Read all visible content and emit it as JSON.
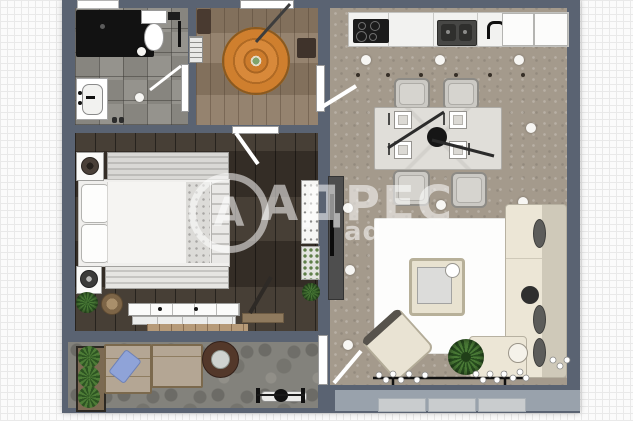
{
  "document": {
    "type": "apartment floor plan (top-down render) on graph paper with real-estate watermark",
    "background": "white graph paper grid"
  },
  "watermark": {
    "logo_letter": "А",
    "brand": "АДРЕС",
    "subtext_partial": "ad",
    "color": "rgba(255,255,255,0.55)"
  },
  "palette": {
    "paper": "#fbfbfb",
    "grid": "#e9e9e9",
    "wall": "#5a6372",
    "tile": "#8f8d87",
    "hallwood": "#8d7a64",
    "bedwood": "#40372e",
    "livfloor": "#a49a8c",
    "stone": "#83827c",
    "ledge": "#99a2ac",
    "bed": "#f0efed",
    "sofa": "#ece6d6",
    "rug_orange": "#cf7f2e",
    "accent_blue": "#8fa3d8",
    "plant_green": "#4a7a36"
  },
  "rooms": [
    {
      "name": "bathroom",
      "floor": "grey ceramic tile",
      "items": [
        "shower",
        "toilet",
        "vanity-sink",
        "towel-rail",
        "door"
      ]
    },
    {
      "name": "entry-hall",
      "floor": "light wood planks",
      "items": [
        "round-orange-rug",
        "entry-door",
        "doormat",
        "shoe-rack"
      ]
    },
    {
      "name": "bedroom",
      "floor": "dark wood planks",
      "items": [
        "double-bed",
        "headboard-shelf",
        "nightstand-lamp",
        "nightstand-speaker",
        "plants",
        "basket",
        "low-dresser",
        "wardrobe"
      ]
    },
    {
      "name": "living-kitchen",
      "floor": "taupe screed",
      "items": [
        "kitchen-counter",
        "hob",
        "sink",
        "fridge",
        "dining-table-4-chairs",
        "tv-unit",
        "white-rug",
        "coffee-table",
        "armchair",
        "corner-sofa",
        "plant",
        "window-flower-boxes"
      ]
    },
    {
      "name": "balcony",
      "floor": "stone",
      "items": [
        "planter",
        "two-loungers",
        "blue-pillow",
        "round-table",
        "exercise-bench"
      ]
    }
  ]
}
